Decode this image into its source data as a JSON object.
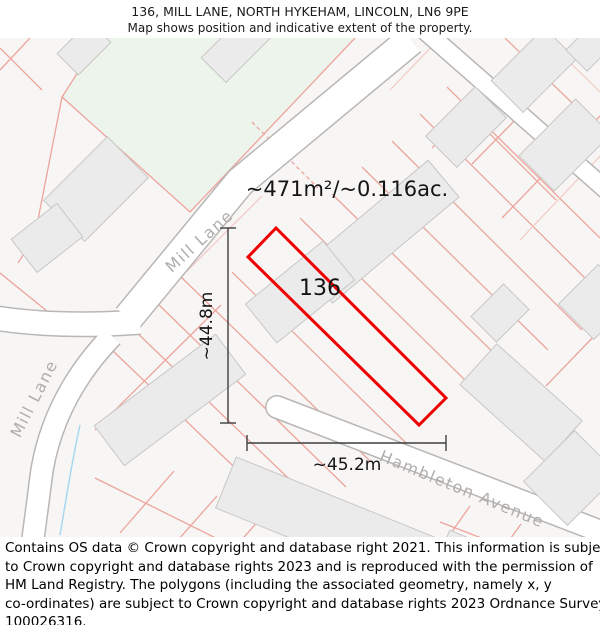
{
  "header": {
    "title": "136, MILL LANE, NORTH HYKEHAM, LINCOLN, LN6 9PE",
    "subtitle": "Map shows position and indicative extent of the property."
  },
  "map": {
    "area_label": "~471m²/~0.116ac.",
    "plot_number": "136",
    "dim_vertical": "~44.8m",
    "dim_horizontal": "~45.2m",
    "street_labels": {
      "mill_lane_upper": "Mill Lane",
      "mill_lane_lower": "Mill Lane",
      "hambleton_avenue": "Hambleton Avenue"
    },
    "colors": {
      "plot_outline": "#ee0000",
      "greenspace": "#edf4ec",
      "parcel_line": "#eda49c",
      "road_edge": "#b9b7b5",
      "building_fill": "#ebebeb",
      "street_label": "#b0aeac",
      "dimension": "#3f3f3f",
      "water": "#a8d8ee"
    }
  },
  "footer": {
    "lines": [
      "Contains OS data © Crown copyright and database right 2021. This information is subject",
      "to Crown copyright and database rights 2023 and is reproduced with the permission of",
      "HM Land Registry. The polygons (including the associated geometry, namely x, y",
      "co-ordinates) are subject to Crown copyright and database rights 2023 Ordnance Survey",
      "100026316."
    ]
  }
}
